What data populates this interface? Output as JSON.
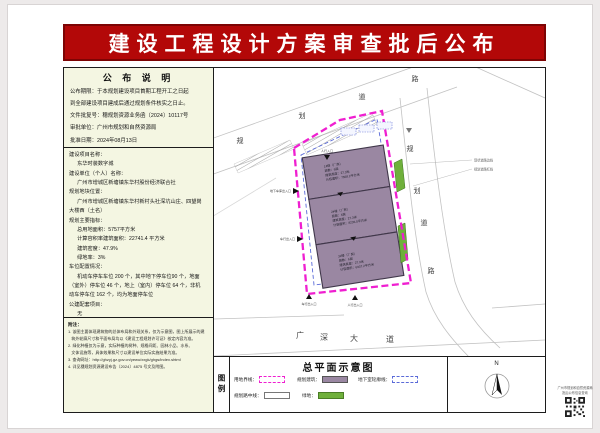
{
  "banner": {
    "title": "建设工程设计方案审查批后公布"
  },
  "colors": {
    "banner_red": "#b30808",
    "panel_bg": "#f4f6e2",
    "boundary_magenta": "#ef1fd0",
    "building_purple": "#9a87a2",
    "green": "#6fb03b",
    "underground_blue": "#5a6ad8"
  },
  "announcement": {
    "title": "公 布 说 明",
    "lines": [
      "公布期限：于本规划建设项目首期工程开工之日起",
      "到全部建设项目建成后通过规划条件核实之日止。",
      "文件批复号：穗规划资源业务函〔2024〕10117号",
      "审批单位：广州市规划和自然资源局",
      "批准日期：2024年08月13日"
    ]
  },
  "project": {
    "lines": [
      "建设项目名称：",
      "　  东华时装数字城",
      "建设单位（个人）名称：",
      "　  广州市增城区新塘镇东华村股份经济联合社",
      "规划地块位置：",
      "　  广州市增城区新塘镇东华村新村头社深坑山庄、四望岗",
      "大楼西（土名）",
      "规划主要指标：",
      "　  总用地面积：5757平方米",
      "　  计算容积率建筑面积：22741.4 平方米",
      "　  建筑密度：47.9%",
      "　  绿地率：3%",
      "车位配置情况：",
      "　  机动车停车车位 200 个，其中地下停车位90 个，地面",
      "（室外）停车位 46 个，地上（室内）停车位 64 个，非机",
      "动车停车位 162 个，均为地面停车位",
      "公建配套项目：",
      "　  无"
    ]
  },
  "notes": {
    "heading": "附注：",
    "lines": [
      "1. 该图主要体现建筑物的总体布局和外观关系，仅为示意图，图上所展示的建",
      "   筑外轮廓尺寸和平面布局均以《建设工程规划许可证》核定内容为准。",
      "2. 绿化种植仅为示意，实际种植的树种、规格间距、园林小品、水系、",
      "   文体设施等，具体效果和尺寸以建设单位实际实施结果为准。",
      "3. 查询网址：http://ghzyj.gz.gov.cn/yewu/xxgk/ghgs/index.shtml",
      "4. 详见穗规划资源建设布告〔2024〕4875 号文及附图。"
    ]
  },
  "plan": {
    "road_labels": {
      "top": [
        "规",
        "划",
        "道",
        "路"
      ],
      "right": [
        "规",
        "划",
        "道",
        "路"
      ],
      "bottom": [
        "广",
        "深",
        "大",
        "道"
      ]
    },
    "side_notes": [
      "现状道路边线",
      "规划道路红线"
    ],
    "markers": {
      "ped_top": "人行入口",
      "garage_left": "地下车库出入口",
      "vehicle_left": "车行出入口",
      "vehicle_bottom": "车行出入口",
      "ped_bottom": "人行出入口"
    },
    "buildings": [
      {
        "lines": [
          "1#楼（厂房）",
          "层数：6层",
          "建筑高度：27.3米",
          "计容面积：7568.2平方米"
        ]
      },
      {
        "lines": [
          "2#楼（厂房）",
          "层数：6层",
          "建筑高度：27.3米",
          "计容面积：8236.0平方米"
        ]
      },
      {
        "lines": [
          "3#楼（厂房）",
          "层数：6层",
          "建筑高度：27.3米",
          "计容面积：6937.2平方米"
        ]
      }
    ]
  },
  "legend": {
    "tab": "图例",
    "title": "总平面示意图",
    "items": [
      {
        "label": "用地界线："
      },
      {
        "label": "规划建筑："
      },
      {
        "label": "地下室轮廓线："
      },
      {
        "label": "规划路中线："
      },
      {
        "label": "绿地："
      }
    ]
  },
  "north": {
    "label": "N"
  },
  "qr": {
    "lines": [
      "广州市规划和自然资源局",
      "批后公布信息查询"
    ]
  }
}
